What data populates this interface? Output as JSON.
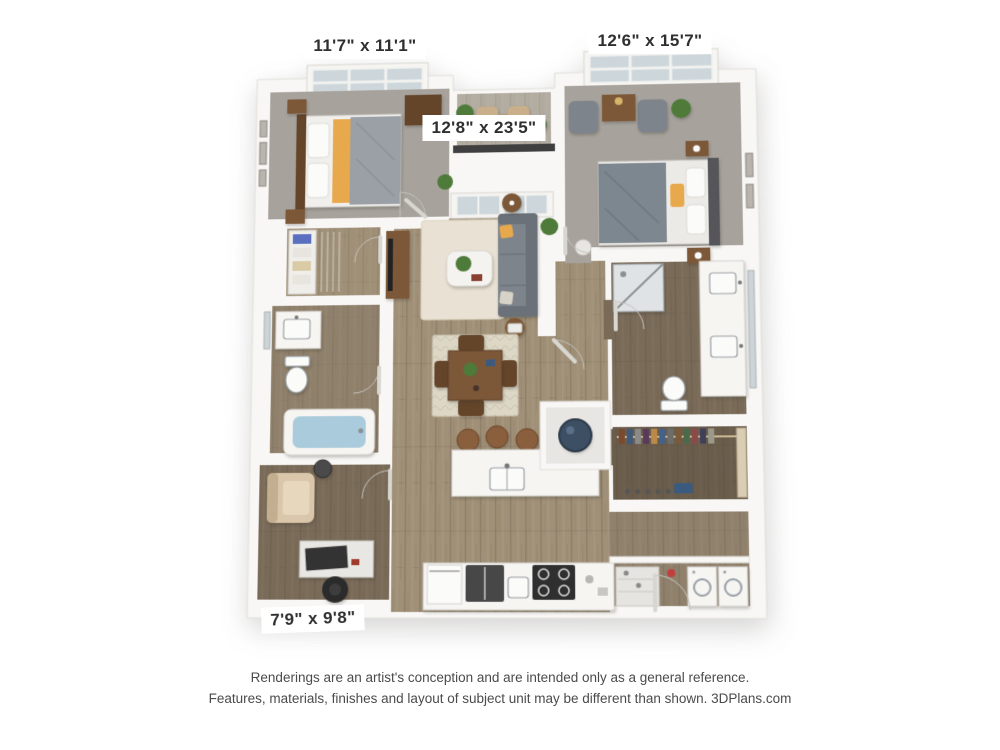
{
  "floor_plan": {
    "dimension_labels": [
      {
        "room": "bedroom-1",
        "text": "11'7\" x 11'1\""
      },
      {
        "room": "bedroom-2",
        "text": "12'6\" x 15'7\""
      },
      {
        "room": "living-area",
        "text": "12'8\" x 23'5\""
      },
      {
        "room": "den",
        "text": "7'9\" x 9'8\""
      }
    ],
    "disclaimer": {
      "line1": "Renderings are an artist's conception and are intended only as a general reference.",
      "line2": "Features, materials, finishes and layout of subject unit may be different than shown. 3DPlans.com"
    },
    "colors": {
      "wall": "#f8f7f5",
      "carpet": "#a7a29c",
      "wood": "#a09077",
      "wood_dark": "#7a6b58",
      "rug": "#e9e1d3",
      "accent": "#e8a84c",
      "water": "#a9cbdc",
      "plant": "#4e7a3a",
      "railing": "#3f3f3f",
      "water_heater": "#3d4f63",
      "label_text": "#2f2f2f",
      "disclaimer_text": "#4b4b4b"
    }
  }
}
